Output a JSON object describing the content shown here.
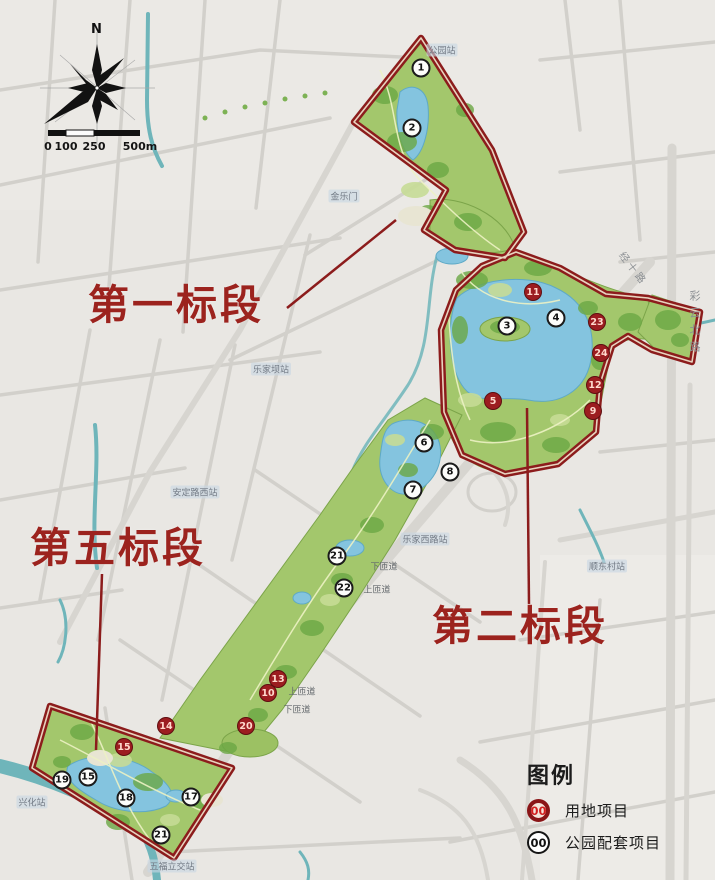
{
  "compass": {
    "north_label": "N"
  },
  "scale_bar": {
    "ticks": [
      "0",
      "100",
      "250",
      "500m"
    ]
  },
  "sections": [
    {
      "id": "first",
      "label": "第一标段"
    },
    {
      "id": "fifth",
      "label": "第五标段"
    },
    {
      "id": "second",
      "label": "第二标段"
    }
  ],
  "legend": {
    "title": "图例",
    "items": [
      {
        "symbol": "00",
        "marker_type": "red",
        "label": "用地项目"
      },
      {
        "symbol": "00",
        "marker_type": "white",
        "label": "公园配套项目"
      }
    ]
  },
  "markers": {
    "red_meaning": "用地项目",
    "white_meaning": "公园配套项目",
    "red": [
      {
        "num": "11",
        "x": 533,
        "y": 292
      },
      {
        "num": "23",
        "x": 597,
        "y": 322
      },
      {
        "num": "24",
        "x": 601,
        "y": 353
      },
      {
        "num": "12",
        "x": 595,
        "y": 385
      },
      {
        "num": "9",
        "x": 593,
        "y": 411
      },
      {
        "num": "5",
        "x": 493,
        "y": 401
      },
      {
        "num": "13",
        "x": 278,
        "y": 679
      },
      {
        "num": "10",
        "x": 268,
        "y": 693
      },
      {
        "num": "20",
        "x": 246,
        "y": 726
      },
      {
        "num": "14",
        "x": 166,
        "y": 726
      },
      {
        "num": "15",
        "x": 124,
        "y": 747
      }
    ],
    "white": [
      {
        "num": "1",
        "x": 421,
        "y": 68
      },
      {
        "num": "2",
        "x": 412,
        "y": 128
      },
      {
        "num": "3",
        "x": 507,
        "y": 326
      },
      {
        "num": "4",
        "x": 556,
        "y": 318
      },
      {
        "num": "6",
        "x": 424,
        "y": 443
      },
      {
        "num": "8",
        "x": 450,
        "y": 472
      },
      {
        "num": "7",
        "x": 413,
        "y": 490
      },
      {
        "num": "21",
        "x": 337,
        "y": 556
      },
      {
        "num": "22",
        "x": 344,
        "y": 588
      },
      {
        "num": "19",
        "x": 62,
        "y": 780
      },
      {
        "num": "15",
        "x": 88,
        "y": 777
      },
      {
        "num": "18",
        "x": 126,
        "y": 798
      },
      {
        "num": "17",
        "x": 191,
        "y": 797
      },
      {
        "num": "21",
        "x": 161,
        "y": 835
      }
    ]
  },
  "place_labels": [
    {
      "text": "公园站",
      "x": 442,
      "y": 50,
      "kind": "station"
    },
    {
      "text": "金乐门",
      "x": 344,
      "y": 196,
      "kind": "station"
    },
    {
      "text": "乐家坝站",
      "x": 271,
      "y": 369,
      "kind": "station"
    },
    {
      "text": "安定路西站",
      "x": 195,
      "y": 492,
      "kind": "station"
    },
    {
      "text": "乐家西路站",
      "x": 425,
      "y": 539,
      "kind": "station"
    },
    {
      "text": "顺东村站",
      "x": 607,
      "y": 566,
      "kind": "station"
    },
    {
      "text": "兴化站",
      "x": 32,
      "y": 802,
      "kind": "station"
    },
    {
      "text": "五福立交站",
      "x": 172,
      "y": 866,
      "kind": "station"
    },
    {
      "text": "下匝道",
      "x": 384,
      "y": 566,
      "kind": "road"
    },
    {
      "text": "上匝道",
      "x": 377,
      "y": 589,
      "kind": "road"
    },
    {
      "text": "上匝道",
      "x": 302,
      "y": 691,
      "kind": "road"
    },
    {
      "text": "下匝道",
      "x": 297,
      "y": 709,
      "kind": "road"
    },
    {
      "text": "彩云北路",
      "x": 694,
      "y": 290,
      "kind": "road-vertical"
    },
    {
      "text": "经十路",
      "x": 634,
      "y": 268,
      "kind": "road-diagonal"
    }
  ],
  "colors": {
    "background": "#e9e7e3",
    "road_gray": "#d2d0cb",
    "river_teal": "#6fb5ba",
    "park_green": "#a3c76c",
    "canopy_green": "#6ca845",
    "water_blue": "#84c4df",
    "boundary_red": "#8c1c1c",
    "section_label_red": "#9c231e",
    "red_marker_fill": "#9c1d20"
  }
}
